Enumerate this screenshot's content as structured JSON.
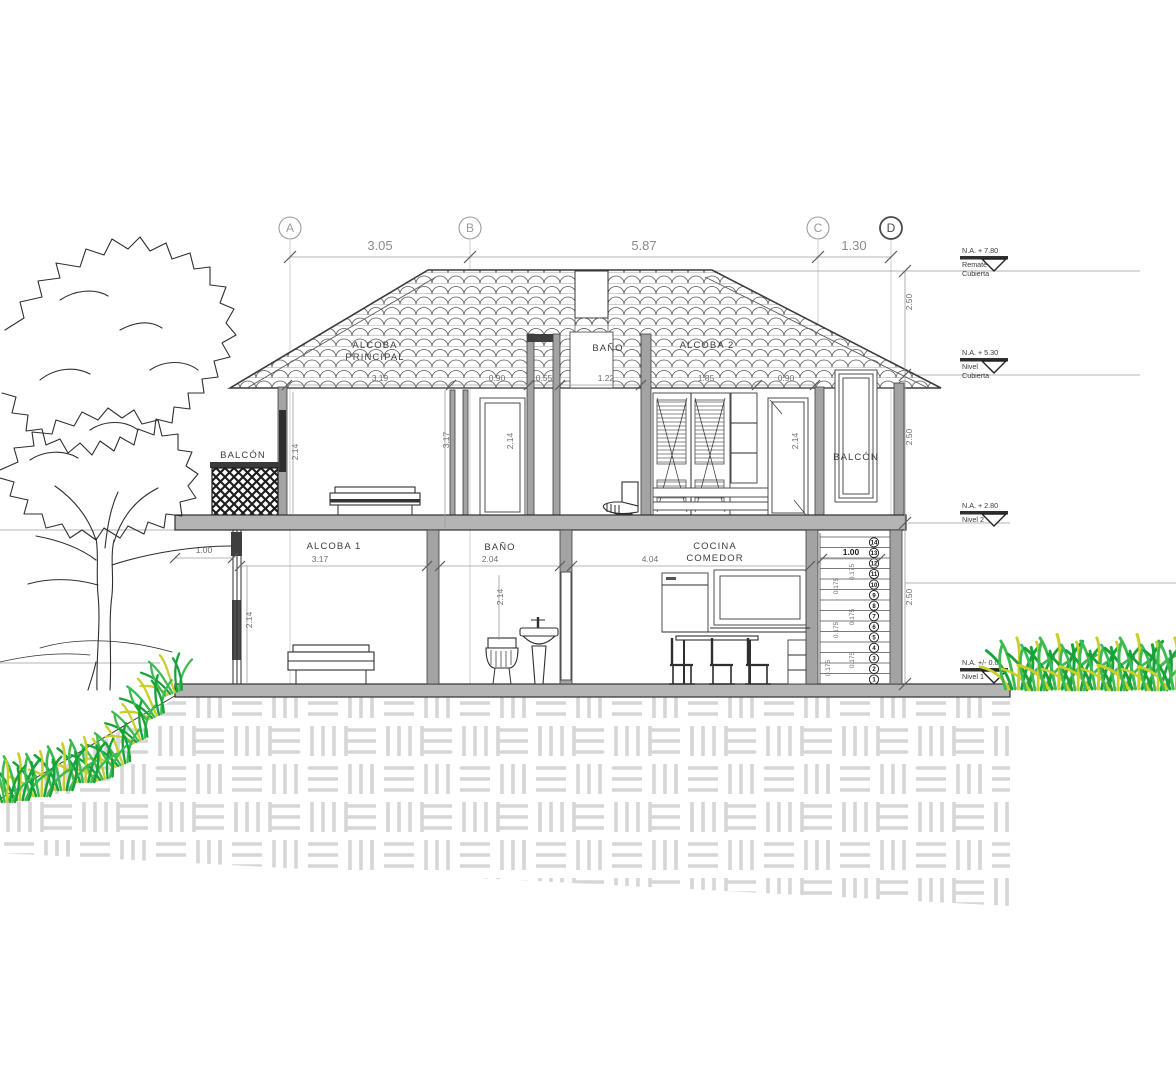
{
  "drawing": {
    "axes": [
      "A",
      "B",
      "C",
      "D"
    ],
    "axis_dims": [
      "3.05",
      "5.87",
      "1.30"
    ],
    "levels": [
      {
        "elev": "N.A. +   7.80",
        "name1": "Remate",
        "name2": "Cubierta"
      },
      {
        "elev": "N.A. +   5.30",
        "name1": "Nivel",
        "name2": "Cubierta"
      },
      {
        "elev": "N.A. +   2.80",
        "name1": "Nivel 2",
        "name2": ""
      },
      {
        "elev": "N.A. +/- 0.0",
        "name1": "Nivel 1",
        "name2": ""
      }
    ],
    "rooms": {
      "alcoba_principal_l1": "ALCOBA",
      "alcoba_principal_l2": "PRINCIPAL",
      "bano_p2": "BAÑO",
      "alcoba2": "ALCOBA 2",
      "balcon_left": "BALCÓN",
      "balcon_right": "BALCÓN",
      "alcoba1": "ALCOBA 1",
      "bano_p1": "BAÑO",
      "cocina_l1": "COCINA",
      "cocina_l2": "COMEDOR"
    },
    "dims": {
      "upper_widths": [
        "3.19",
        "0.90",
        "0.55",
        "1.22",
        "1.85",
        "0.90"
      ],
      "lower_widths": [
        "3.17",
        "2.04",
        "4.04"
      ],
      "heights_upper": [
        "2.14",
        "3.17",
        "2.14",
        "2.14"
      ],
      "heights_lower": [
        "2.14",
        "2.14"
      ],
      "right_heights": [
        "2.50",
        "2.50",
        "2.50"
      ],
      "balcony_width": "1.00",
      "stair_width": "1.00",
      "riser": "0.175"
    },
    "stairs": {
      "steps": [
        "1",
        "2",
        "3",
        "4",
        "5",
        "6",
        "7",
        "8",
        "9",
        "10",
        "11",
        "12",
        "13",
        "14"
      ]
    }
  }
}
